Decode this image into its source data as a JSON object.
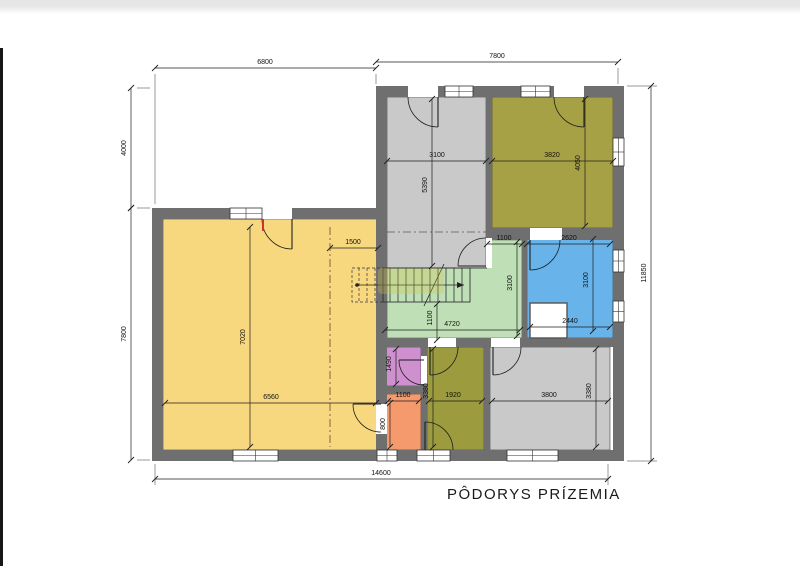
{
  "title": {
    "label": "PÔDORYS PRÍZEMIA"
  },
  "page": {
    "bg": "#ffffff",
    "top_strip": "#e7e7e7",
    "left_bar": "#171717"
  },
  "plan": {
    "wall_color": "#6f6f6f",
    "line_color": "#1e1e1e",
    "rooms": [
      {
        "name": "living-room",
        "color": "#f8d87e",
        "rect": [
          163,
          219,
          215,
          231
        ]
      },
      {
        "name": "entrance-hall",
        "color": "#c9c9c9",
        "rect": [
          387,
          97,
          99,
          171
        ]
      },
      {
        "name": "room-top-right",
        "color": "#a7a145",
        "rect": [
          492,
          97,
          121,
          131
        ]
      },
      {
        "name": "bathroom",
        "color": "#68b3e9",
        "rect": [
          527,
          237,
          86,
          101
        ]
      },
      {
        "name": "corridor-stairs",
        "color": "#bfe0b6",
        "poly": "387,268 487,268 487,240 522,240 522,338 387,338"
      },
      {
        "name": "wc",
        "color": "#cf90cf",
        "rect": [
          386,
          347,
          35,
          39
        ]
      },
      {
        "name": "pantry",
        "color": "#f59a6c",
        "rect": [
          386,
          394,
          35,
          56
        ]
      },
      {
        "name": "room-bottom-middle",
        "color": "#9c9b3d",
        "rect": [
          427,
          347,
          57,
          103
        ]
      },
      {
        "name": "room-bottom-right",
        "color": "#c9c9c9",
        "rect": [
          490,
          347,
          120,
          103
        ]
      }
    ],
    "walls": [
      [
        376,
        86,
        248,
        11
      ],
      [
        613,
        86,
        11,
        375
      ],
      [
        152,
        450,
        472,
        11
      ],
      [
        152,
        208,
        11,
        253
      ],
      [
        152,
        208,
        224,
        11
      ],
      [
        376,
        86,
        11,
        364
      ],
      [
        486,
        97,
        6,
        171
      ],
      [
        486,
        228,
        127,
        12
      ],
      [
        522,
        240,
        5,
        98
      ],
      [
        376,
        338,
        237,
        9
      ],
      [
        421,
        347,
        6,
        103
      ],
      [
        484,
        347,
        6,
        103
      ],
      [
        378,
        386,
        43,
        8
      ]
    ],
    "notch": [
      530,
      303,
      37,
      35
    ],
    "windows": [
      [
        445,
        86,
        28,
        11,
        0
      ],
      [
        521,
        86,
        29,
        11,
        0
      ],
      [
        230,
        208,
        32,
        11,
        0
      ],
      [
        233,
        450,
        45,
        11,
        0
      ],
      [
        377,
        450,
        20,
        11,
        0
      ],
      [
        417,
        450,
        33,
        11,
        0
      ],
      [
        507,
        450,
        51,
        11,
        0
      ],
      [
        613,
        250,
        11,
        22,
        1
      ],
      [
        613,
        301,
        11,
        21,
        1
      ],
      [
        613,
        138,
        11,
        28,
        1
      ]
    ],
    "openings": [
      [
        408,
        86,
        30,
        11
      ],
      [
        554,
        86,
        30,
        11
      ],
      [
        262,
        208,
        30,
        11
      ],
      [
        486,
        238,
        6,
        30
      ],
      [
        530,
        228,
        32,
        12
      ],
      [
        421,
        356,
        6,
        28
      ],
      [
        428,
        338,
        28,
        9
      ],
      [
        491,
        338,
        29,
        9
      ],
      [
        376,
        404,
        11,
        30
      ]
    ],
    "doors": [
      {
        "arc": "M 408 97 A 30 30 0 0 0 438 127",
        "leaf": [
          438,
          97,
          438,
          127
        ]
      },
      {
        "arc": "M 554 97 A 30 30 0 0 0 584 127",
        "leaf": [
          584,
          97,
          584,
          127
        ]
      },
      {
        "arc": "M 262 219 A 30 30 0 0 0 292 249",
        "leaf": [
          292,
          219,
          292,
          249
        ],
        "jamb": [
          263,
          219,
          263,
          231
        ]
      },
      {
        "arc": "M 486 238 A 28 28 0 0 0 458 266",
        "leaf": [
          486,
          266,
          458,
          266
        ]
      },
      {
        "arc": "M 560 240 A 30 30 0 0 1 530 270",
        "leaf": [
          530,
          240,
          530,
          270
        ]
      },
      {
        "arc": "M 399 360 A 25 25 0 0 0 424 385",
        "leaf": [
          424,
          360,
          399,
          360
        ]
      },
      {
        "arc": "M 458 347 A 28 28 0 0 1 430 375",
        "leaf": [
          430,
          347,
          430,
          375
        ]
      },
      {
        "arc": "M 521 347 A 28 28 0 0 1 493 375",
        "leaf": [
          493,
          347,
          493,
          375
        ]
      },
      {
        "arc": "M 453 450 A 28 28 0 0 0 425 422",
        "leaf": [
          425,
          450,
          425,
          422
        ]
      },
      {
        "arc": "M 353 404 A 28 28 0 0 0 381 432",
        "leaf": [
          381,
          404,
          353,
          404
        ]
      }
    ],
    "stairs": {
      "outline": [
        383,
        268,
        87,
        34
      ],
      "tread_x": [
        390,
        398,
        406,
        414,
        422,
        430,
        438,
        446,
        454,
        462
      ],
      "tread_y": [
        268,
        302
      ],
      "dashed_outline": [
        352,
        268,
        31,
        34
      ],
      "dashed_tread_x": [
        359,
        367,
        375
      ],
      "walk_line": [
        357,
        285,
        464,
        285
      ],
      "break_line": [
        424,
        306,
        444,
        264
      ]
    },
    "boundary_lines": [
      [
        387,
        268,
        487,
        268
      ]
    ],
    "dashdot": [
      [
        330,
        227,
        330,
        447
      ],
      [
        387,
        232,
        486,
        232
      ]
    ],
    "extensions": [
      [
        155,
        74,
        155,
        204
      ],
      [
        376,
        74,
        376,
        84
      ],
      [
        618,
        68,
        618,
        84
      ],
      [
        137,
        88,
        150,
        88
      ],
      [
        137,
        208,
        150,
        208
      ],
      [
        137,
        460,
        150,
        460
      ],
      [
        627,
        86,
        657,
        86
      ],
      [
        627,
        461,
        657,
        461
      ],
      [
        155,
        464,
        155,
        485
      ],
      [
        608,
        464,
        608,
        485
      ]
    ],
    "dims": [
      {
        "t": "6800",
        "l": [
          155,
          68,
          376,
          68
        ],
        "p": [
          265,
          64
        ]
      },
      {
        "t": "7800",
        "l": [
          376,
          62,
          618,
          62
        ],
        "p": [
          497,
          58
        ]
      },
      {
        "t": "4000",
        "l": [
          131,
          88,
          131,
          208
        ],
        "p": [
          126,
          148
        ],
        "r": 1
      },
      {
        "t": "7800",
        "l": [
          131,
          208,
          131,
          460
        ],
        "p": [
          126,
          334
        ],
        "r": 1
      },
      {
        "t": "11850",
        "l": [
          651,
          86,
          651,
          461
        ],
        "p": [
          646,
          273
        ],
        "r": 1
      },
      {
        "t": "14600",
        "l": [
          155,
          479,
          608,
          479
        ],
        "p": [
          381,
          475
        ]
      },
      {
        "t": "3100",
        "l": [
          387,
          161,
          486,
          161
        ],
        "p": [
          437,
          157
        ]
      },
      {
        "t": "3820",
        "l": [
          492,
          161,
          613,
          161
        ],
        "p": [
          552,
          157
        ]
      },
      {
        "t": "5390",
        "l": [
          432,
          99,
          432,
          266
        ],
        "p": [
          427,
          185
        ],
        "r": 1
      },
      {
        "t": "4050",
        "l": [
          585,
          99,
          585,
          226
        ],
        "p": [
          580,
          163
        ],
        "r": 1
      },
      {
        "t": "1500",
        "l": [
          330,
          248,
          378,
          248
        ],
        "p": [
          353,
          244
        ]
      },
      {
        "t": "7020",
        "l": [
          250,
          227,
          250,
          447
        ],
        "p": [
          245,
          337
        ],
        "r": 1
      },
      {
        "t": "6560",
        "l": [
          165,
          403,
          376,
          403
        ],
        "p": [
          271,
          399
        ]
      },
      {
        "t": "1100",
        "l": [
          487,
          244,
          522,
          244
        ],
        "p": [
          504,
          240
        ]
      },
      {
        "t": "2620",
        "l": [
          527,
          244,
          610,
          244
        ],
        "p": [
          569,
          240
        ]
      },
      {
        "t": "3100",
        "l": [
          517,
          242,
          517,
          336
        ],
        "p": [
          512,
          283
        ],
        "r": 1
      },
      {
        "t": "3100",
        "l": [
          593,
          239,
          593,
          331
        ],
        "p": [
          588,
          280
        ],
        "r": 1
      },
      {
        "t": "1100",
        "l": [
          437,
          304,
          437,
          340
        ],
        "p": [
          432,
          318
        ],
        "r": 1
      },
      {
        "t": "4720",
        "l": [
          385,
          330,
          520,
          330
        ],
        "p": [
          452,
          326
        ]
      },
      {
        "t": "2440",
        "l": [
          530,
          327,
          610,
          327
        ],
        "p": [
          570,
          323
        ]
      },
      {
        "t": "1490",
        "l": [
          396,
          349,
          396,
          384
        ],
        "p": [
          391,
          364
        ],
        "r": 1
      },
      {
        "t": "1100",
        "l": [
          388,
          401,
          419,
          401
        ],
        "p": [
          403,
          397
        ]
      },
      {
        "t": "800",
        "l": [
          390,
          403,
          390,
          447
        ],
        "p": [
          385,
          424
        ],
        "r": 1
      },
      {
        "t": "1920",
        "l": [
          429,
          401,
          482,
          401
        ],
        "p": [
          453,
          397
        ]
      },
      {
        "t": "3380",
        "l": [
          433,
          349,
          433,
          447
        ],
        "p": [
          428,
          391
        ],
        "r": 1
      },
      {
        "t": "3800",
        "l": [
          492,
          401,
          608,
          401
        ],
        "p": [
          549,
          397
        ]
      },
      {
        "t": "3380",
        "l": [
          596,
          349,
          596,
          447
        ],
        "p": [
          591,
          391
        ],
        "r": 1
      }
    ],
    "watermark": {
      "rect": [
        378,
        268,
        66,
        26
      ],
      "color": "#d2c24a",
      "opacity": 0.3
    }
  }
}
